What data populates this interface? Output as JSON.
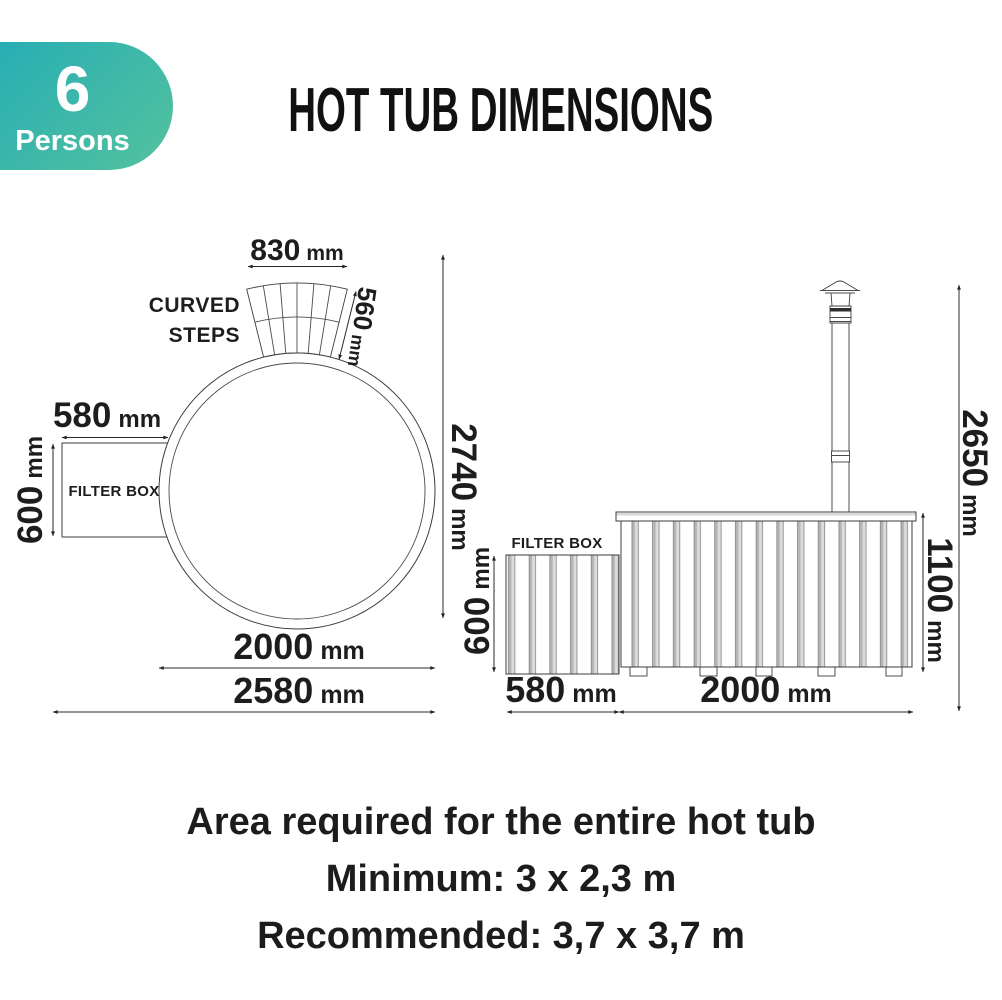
{
  "badge": {
    "number": "6",
    "label": "Persons",
    "gradient_start": "#28aeb4",
    "gradient_end": "#54c29d"
  },
  "title": "HOT TUB DIMENSIONS",
  "top_view": {
    "curved_steps_line1": "CURVED",
    "curved_steps_line2": "STEPS",
    "filter_box_label": "FILTER BOX",
    "dims": {
      "steps_width": {
        "value": "830",
        "unit": "mm"
      },
      "steps_depth": {
        "value": "560",
        "unit": "mm"
      },
      "filter_width": {
        "value": "580",
        "unit": "mm"
      },
      "filter_height": {
        "value": "600",
        "unit": "mm"
      },
      "total_depth": {
        "value": "2740",
        "unit": "mm"
      },
      "diameter": {
        "value": "2000",
        "unit": "mm"
      },
      "total_width": {
        "value": "2580",
        "unit": "mm"
      }
    }
  },
  "side_view": {
    "filter_box_label": "FILTER BOX",
    "dims": {
      "total_height": {
        "value": "2650",
        "unit": "mm"
      },
      "tub_height": {
        "value": "1100",
        "unit": "mm"
      },
      "filter_height": {
        "value": "600",
        "unit": "mm"
      },
      "filter_width": {
        "value": "580",
        "unit": "mm"
      },
      "tub_width": {
        "value": "2000",
        "unit": "mm"
      }
    }
  },
  "footer": {
    "line1": "Area required for the entire hot tub",
    "line2": "Minimum: 3 x 2,3 m",
    "line3": "Recommended: 3,7 x 3,7 m"
  }
}
